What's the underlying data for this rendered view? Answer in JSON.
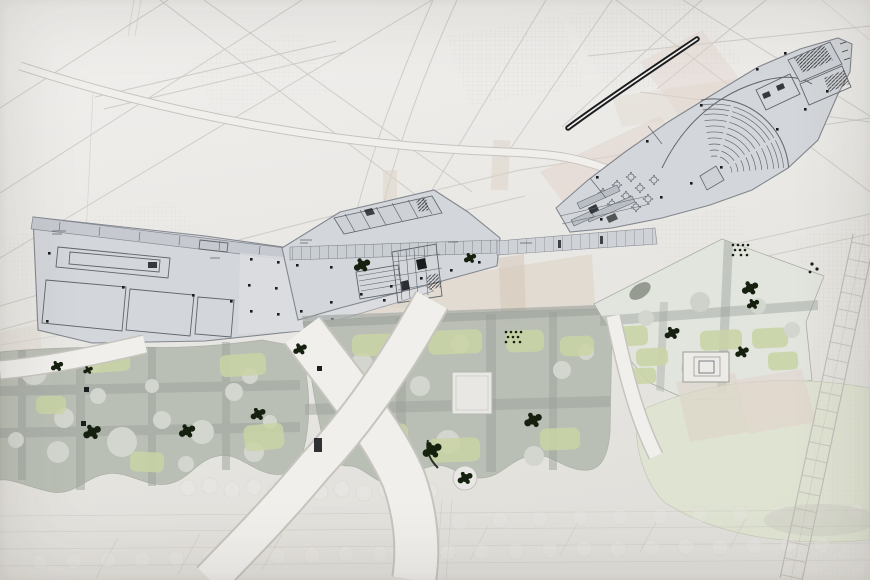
{
  "meta": {
    "description": "Photograph of an architectural masterplan drawing: three angular building ground-floor plans linked diagonally across the sheet (west wing with columned hall, central wedge with colonnade corridor, east slab with fan auditorium and cafe), a black double-line canopy mark, a landscaped park below with sage planting blocks, tree circles, lawns, dark tree scribbles and sweeping white pedestrian paths, a pale green field at lower right, faint street-grid underlay and a rail ladder band on the right edge.",
    "visible_text": "no legible text (plan labels are below legibility)"
  },
  "palette": {
    "paper": "#ebe9e6",
    "paper_hi": "#f1f0ee",
    "paper_lo": "#e2e0db",
    "faint_line": "#c8c5bf",
    "hatch_line": "#d8d5cf",
    "street_beige": "#dcd1c5",
    "street_pink": "#e1d2ca",
    "tan_deep": "#d3c6b6",
    "building_fill": "#d3d6da",
    "building_fill_light": "#dbdde0",
    "building_band": "#c6cad0",
    "building_stroke": "#82878f",
    "building_detail": "#60656c",
    "ink": "#1b1c1e",
    "park_street": "#9ba19c",
    "sage_mass": "#b8bdb3",
    "sage_circle": "#d3d6cf",
    "lawn_green": "#c9d4a6",
    "pale_green": "#dfe3d0",
    "tree_ink": "#16200f",
    "path_white": "#f0efec",
    "track_line": "#c1beb8",
    "paving_light": "#e8e7e3",
    "building_small": "#edebe7"
  },
  "components": [
    {
      "name": "street-grid-underlay",
      "kind": "faint diagonal street network"
    },
    {
      "name": "crosshatch-areas",
      "kind": "fine grid hatched city blocks"
    },
    {
      "name": "tinted-streets",
      "kind": "beige and pink street tints"
    },
    {
      "name": "west-building-plan",
      "kind": "floor plan, rooms and columned hall"
    },
    {
      "name": "central-building-plan",
      "kind": "floor plan, colonnade corridor and seating"
    },
    {
      "name": "east-building-plan",
      "kind": "floor plan, fan auditorium, cafe tables, stair cores"
    },
    {
      "name": "black-canopy-line",
      "kind": "bold double-line canopy mark"
    },
    {
      "name": "park-blocks",
      "kind": "landscape plan: sage masses, tree circles, lawns"
    },
    {
      "name": "tree-clusters",
      "kind": "dark planting scribbles"
    },
    {
      "name": "pavilion-footprint",
      "kind": "small nested-square building"
    },
    {
      "name": "curved-pedestrian-paths",
      "kind": "white sweeping paths"
    },
    {
      "name": "rail-band",
      "kind": "ladder / track band at right edge"
    },
    {
      "name": "promenade-strip",
      "kind": "bottom strip with faint tree circles"
    }
  ]
}
